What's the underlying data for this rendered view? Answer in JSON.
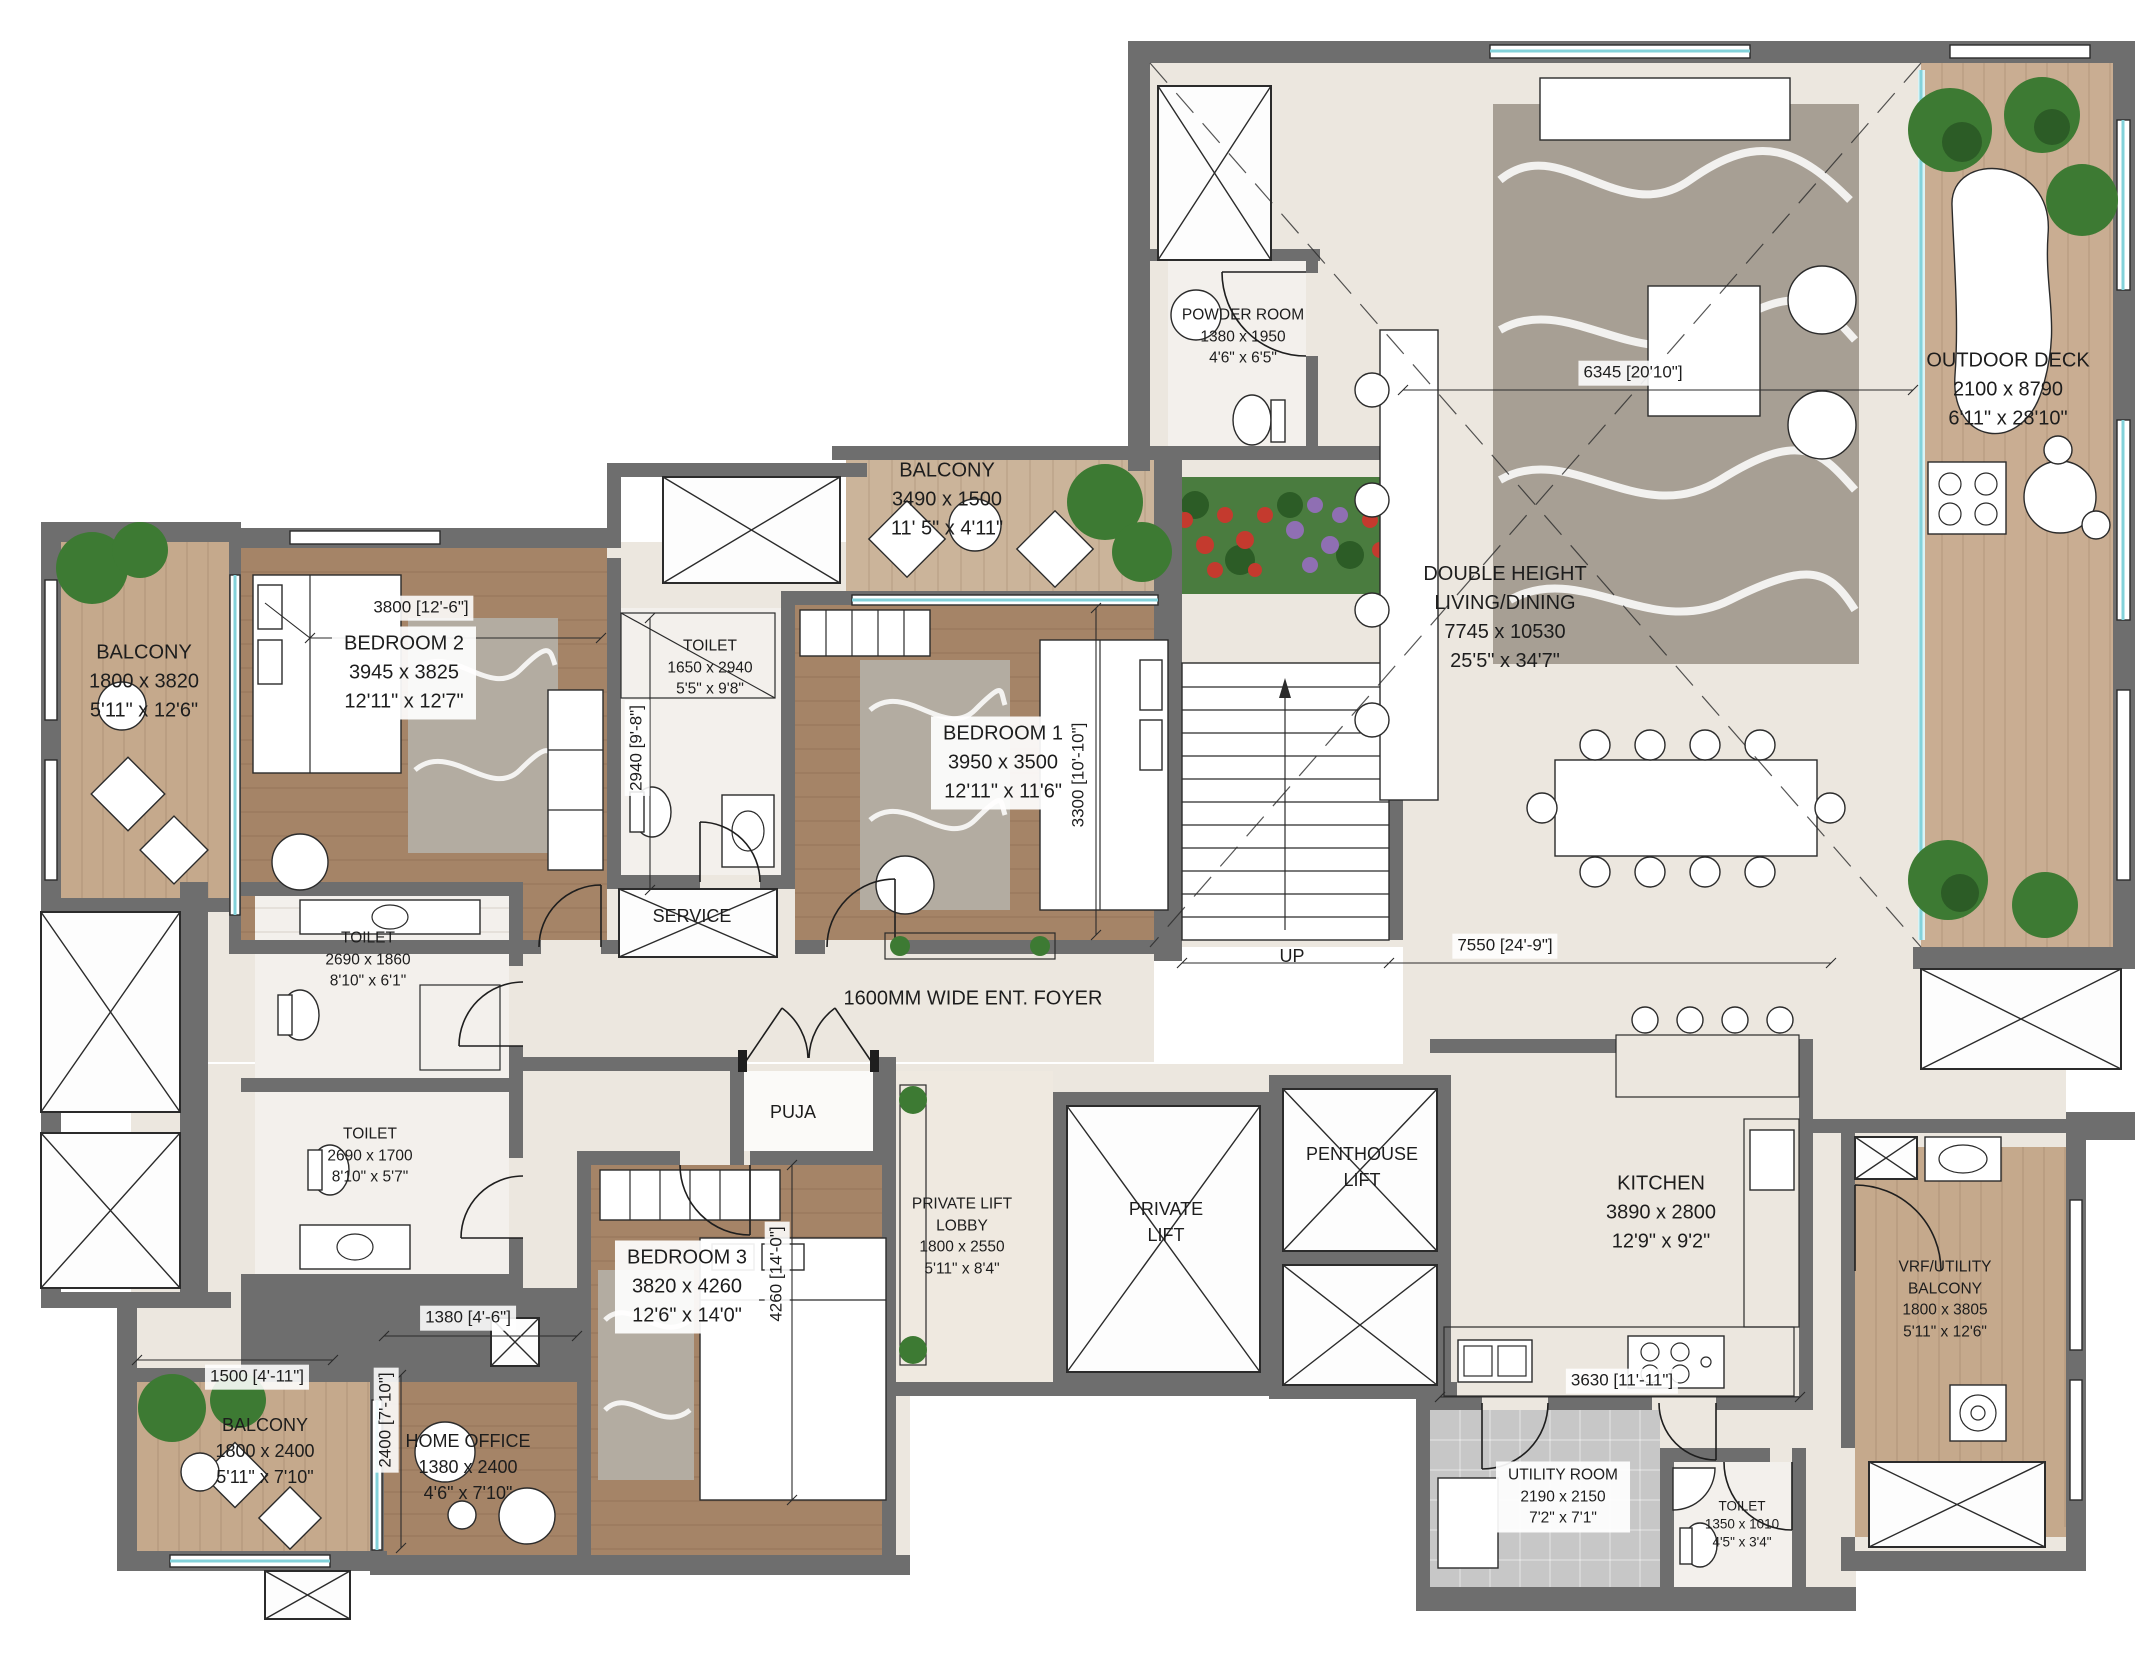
{
  "rooms": {
    "outdoor_deck": {
      "name": "OUTDOOR DECK",
      "mm": "2100 x 8790",
      "ft": "6'11\" x 28'10\""
    },
    "powder_room": {
      "name": "POWDER ROOM",
      "mm": "1380 x 1950",
      "ft": "4'6\" x 6'5\""
    },
    "living_dining": {
      "name1": "DOUBLE HEIGHT",
      "name2": "LIVING/DINING",
      "mm": "7745 x 10530",
      "ft": "25'5\" x 34'7\""
    },
    "balcony_top": {
      "name": "BALCONY",
      "mm": "3490 x 1500",
      "ft": "11' 5\" x 4'11\""
    },
    "bedroom2": {
      "name": "BEDROOM 2",
      "mm": "3945 x 3825",
      "ft": "12'11\" x 12'7\""
    },
    "balcony_left": {
      "name": "BALCONY",
      "mm": "1800 x 3820",
      "ft": "5'11\" x 12'6\""
    },
    "toilet_master": {
      "name": "TOILET",
      "mm": "1650 x 2940",
      "ft": "5'5\" x 9'8\""
    },
    "bedroom1": {
      "name": "BEDROOM 1",
      "mm": "3950 x 3500",
      "ft": "12'11\" x 11'6\""
    },
    "toilet_mid1": {
      "name": "TOILET",
      "mm": "2690 x 1860",
      "ft": "8'10\" x 6'1\""
    },
    "toilet_mid2": {
      "name": "TOILET",
      "mm": "2690 x 1700",
      "ft": "8'10\" x 5'7\""
    },
    "service": {
      "name": "SERVICE"
    },
    "foyer": {
      "name": "1600MM WIDE ENT. FOYER"
    },
    "puja": {
      "name": "PUJA"
    },
    "bedroom3": {
      "name": "BEDROOM 3",
      "mm": "3820 x 4260",
      "ft": "12'6\" x 14'0\""
    },
    "lift_lobby": {
      "name1": "PRIVATE LIFT",
      "name2": "LOBBY",
      "mm": "1800 x 2550",
      "ft": "5'11\" x 8'4\""
    },
    "private_lift": {
      "name1": "PRIVATE",
      "name2": "LIFT"
    },
    "penthouse_lift": {
      "name1": "PENTHOUSE",
      "name2": "LIFT"
    },
    "kitchen": {
      "name": "KITCHEN",
      "mm": "3890 x 2800",
      "ft": "12'9\" x 9'2\""
    },
    "home_office": {
      "name": "HOME OFFICE",
      "mm": "1380 x 2400",
      "ft": "4'6\" x 7'10\""
    },
    "balcony_bottom": {
      "name": "BALCONY",
      "mm": "1800 x 2400",
      "ft": "5'11\" x 7'10\""
    },
    "utility": {
      "name": "UTILITY ROOM",
      "mm": "2190 x 2150",
      "ft": "7'2\" x 7'1\""
    },
    "toilet_bottom": {
      "name": "TOILET",
      "mm": "1350 x 1010",
      "ft": "4'5\" x 3'4\""
    },
    "vrf_balcony": {
      "name1": "VRF/UTILITY",
      "name2": "BALCONY",
      "mm": "1800 x 3805",
      "ft": "5'11\" x 12'6\""
    }
  },
  "dims": {
    "d3800": "3800 [12'-6\"]",
    "d2940": "2940 [9'-8\"]",
    "d3300": "3300 [10'-10\"]",
    "d6345": "6345 [20'10\"]",
    "d7550": "7550 [24'-9\"]",
    "d1380": "1380 [4'-6\"]",
    "d1500": "1500 [4'-11\"]",
    "d2400": "2400 [7'-10\"]",
    "d4260": "4260 [14'-0\"]",
    "d3630": "3630 [11'-11\"]",
    "up": "UP"
  },
  "colors": {
    "wall": "#6e6e6e",
    "floor_cream": "#ece7df",
    "wood_dark": "#a58467",
    "wood_light": "#c7ab8e",
    "marble": "#f3f0ec",
    "utility_tile": "#c7c7c7",
    "rug": "#a79f94",
    "glass_teal": "#83d2da",
    "planting_green": "#3d7a33",
    "flower_red": "#c43a2e",
    "flower_purple": "#8f6fb3",
    "counter_tan": "#d9cbb8"
  }
}
